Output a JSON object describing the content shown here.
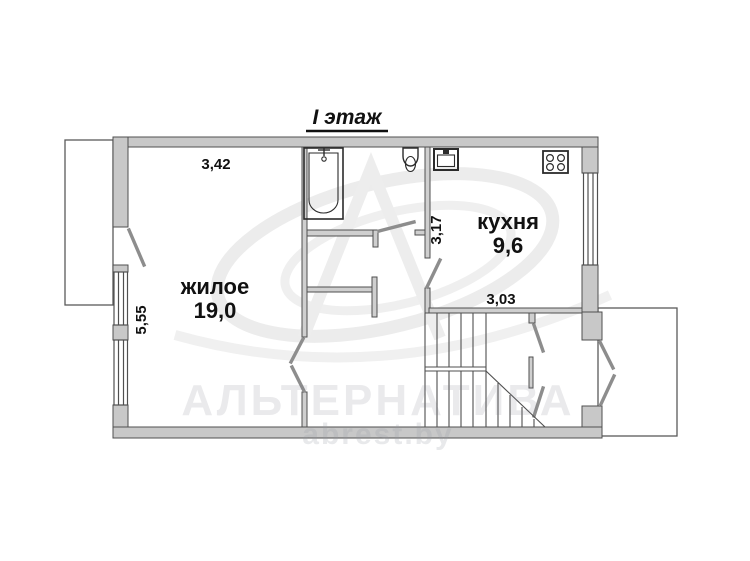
{
  "plan": {
    "title": "I этаж",
    "floor_label_meaning": "1st floor plan",
    "rooms": {
      "living": {
        "name": "жилое",
        "area": "19,0"
      },
      "kitchen": {
        "name": "кухня",
        "area": "9,6"
      }
    },
    "dimensions": {
      "living_width": "3,42",
      "living_height": "5,55",
      "kitchen_height": "3,17",
      "kitchen_width": "3,03"
    },
    "fixtures": [
      "bathtub",
      "toilet",
      "kitchen-sink",
      "stove",
      "staircase"
    ],
    "watermark": {
      "brand": "АЛЬТЕРНАТИВА",
      "site": "abrest.by"
    },
    "colors": {
      "wall_fill": "#c8c8c8",
      "wall_stroke": "#4f4f4f",
      "fixture_stroke": "#2b2b2b",
      "text": "#111111",
      "watermark": "#ebebeb",
      "background": "#ffffff"
    }
  }
}
